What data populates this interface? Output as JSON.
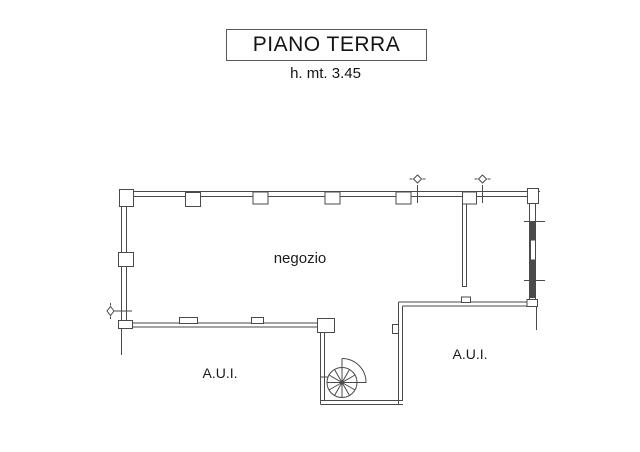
{
  "page": {
    "title": "PIANO TERRA",
    "subtitle": "h. mt. 3.45",
    "background": "#ffffff"
  },
  "plan": {
    "line_color": "#4a4a4a",
    "text_color": "#1c1c1c",
    "labels": {
      "main_room": "negozio",
      "aui_left": "A.U.I.",
      "aui_right": "A.U.I."
    },
    "symbols": [
      "spiral-staircase",
      "window",
      "opening-marker-left",
      "opening-marker-top-1",
      "opening-marker-top-2"
    ]
  }
}
